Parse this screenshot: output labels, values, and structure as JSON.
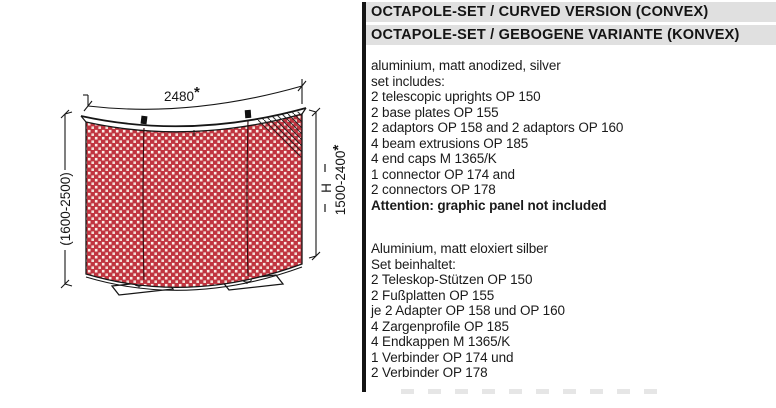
{
  "header": {
    "title_en": "OCTAPOLE-SET / CURVED VERSION (CONVEX)",
    "title_de": "OCTAPOLE-SET / GEBOGENE VARIANTE (KONVEX)"
  },
  "specs_en": {
    "material": "aluminium, matt anodized, silver",
    "set_label": "set includes:",
    "items": [
      "2 telescopic uprights OP 150",
      "2 base plates OP 155",
      "2 adaptors OP 158 and 2 adaptors OP 160",
      "4 beam extrusions OP 185",
      "4 end caps M 1365/K",
      "1 connector OP 174 and",
      "2 connectors OP 178"
    ],
    "attention": "Attention: graphic panel not included"
  },
  "specs_de": {
    "material": "Aluminium, matt eloxiert silber",
    "set_label": "Set beinhaltet:",
    "items": [
      "2 Teleskop-Stützen OP 150",
      "2 Fußplatten OP 155",
      "je 2 Adapter OP 158 und OP 160",
      "4 Zargenprofile OP 185",
      "4 Endkappen M 1365/K",
      "1 Verbinder OP 174 und",
      "2 Verbinder OP 178"
    ]
  },
  "diagram": {
    "width_value": "2480",
    "width_asterisk": "*",
    "overall_height": "(1600-2500)",
    "height_symbol": "H",
    "height_value": "1500-2400",
    "height_asterisk": "*",
    "colors": {
      "panel_red": "#c03540",
      "panel_dot": "#f2ddd5",
      "line_black": "#161616",
      "header_bar_gray": "#e0e0e0"
    }
  }
}
